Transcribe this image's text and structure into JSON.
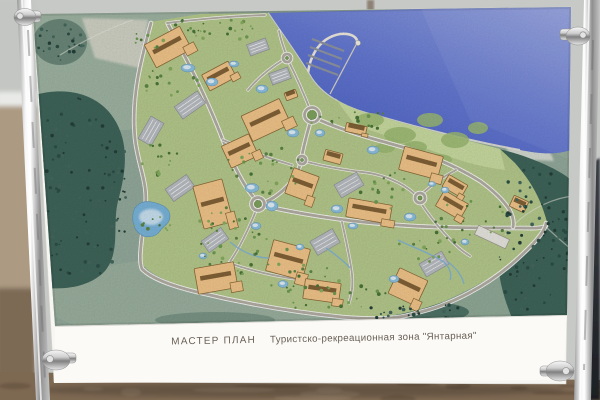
{
  "billboard": {
    "caption": {
      "title": "МАСТЕР ПЛАН",
      "zone": "Туристско-рекреационная зона \"Янтарная\""
    },
    "map_features": [
      "sea",
      "marina-breakwater",
      "boat-piers",
      "coastal-beach",
      "golf-course",
      "resort-buildings",
      "parking-lots",
      "roundabouts",
      "road-network",
      "ponds",
      "lake",
      "streams",
      "forest"
    ]
  },
  "colors": {
    "sky": "#c7c9c6",
    "ground": "#7d6852",
    "ground_dark": "#5d4c3a",
    "ground_light": "#97836b",
    "board": "#f7f6f2",
    "caption_text": "#6a6156",
    "sea_deep": "#4d62c6",
    "sea_light": "#97a5e2",
    "terrain": "#93aa9b",
    "terrain_light": "#a6baa8",
    "forest": "#3f655a",
    "forest_dark": "#2c4f46",
    "dev_green": "#b5c98c",
    "golf_green": "#c9dba0",
    "golf_blob": "#9cba72",
    "road_fill": "#b3aea4",
    "road_edge": "#ffffff",
    "building_fill": "#f2c58a",
    "building_edge": "#8a6a38",
    "roof_dark": "#6e5028",
    "pond": "#8cc0de",
    "lake": "#79b4da",
    "parking": "#b9bdc2",
    "sand": "#d9d8cc",
    "marina": "#eeeadf",
    "pier": "#8f95a0",
    "chrome_light": "#f5f5f5",
    "chrome_dark": "#8f8f8f",
    "person": "#2b2e33"
  }
}
